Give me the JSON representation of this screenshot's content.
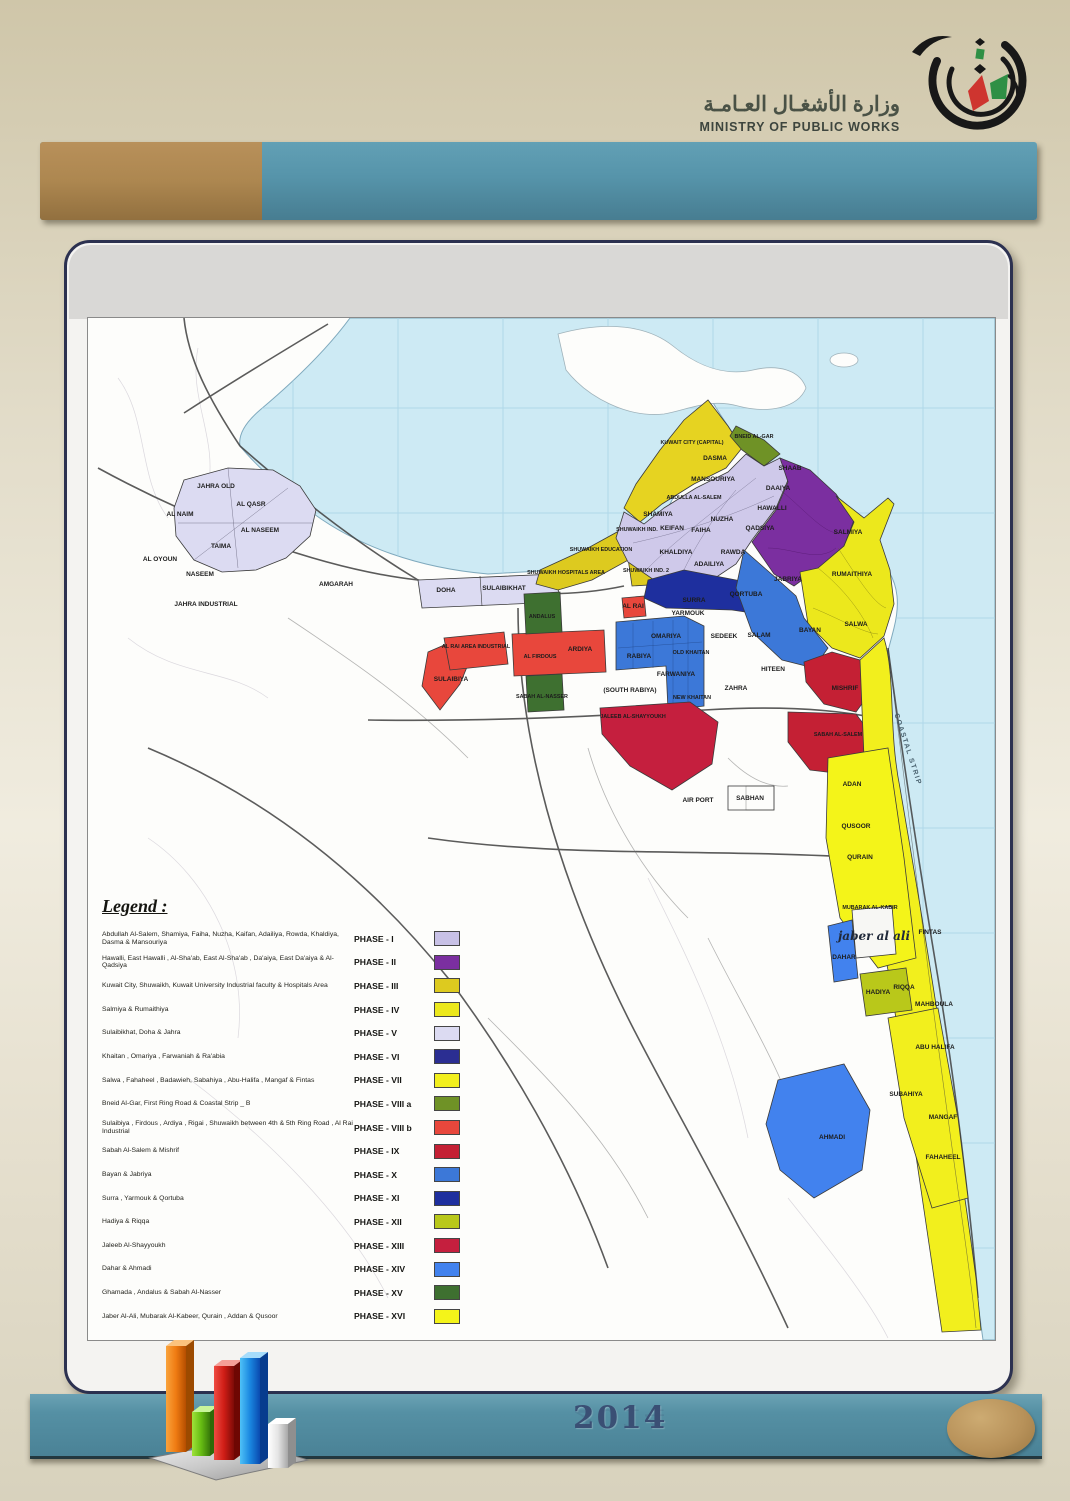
{
  "page": {
    "year": "2014"
  },
  "ministry": {
    "name_ar": "وزارة الأشغـال العـامـة",
    "name_en": "MINISTRY OF PUBLIC WORKS"
  },
  "theme": {
    "header_tan": "#ad8750",
    "header_teal": "#5694aa",
    "footer_teal": "#4f8ca0",
    "card_border": "#2c3150",
    "sea": "#cdeaf4",
    "year_color": "#3a4f74",
    "oval_tan": "#b8925a"
  },
  "legend": {
    "title": "Legend :",
    "entries": [
      {
        "areas": "Abdullah Al-Salem, Shamiya, Faiha, Nuzha, Kaifan, Adailiya, Rowda, Khaldiya, Dasma & Mansouriya",
        "phase": "PHASE - I",
        "color": "#c8c1e6"
      },
      {
        "areas": "Hawalli, East Hawalli , Al-Sha'ab, East Al-Sha'ab , Da'aiya, East Da'aiya & Al-Qadsiya",
        "phase": "PHASE - II",
        "color": "#7b2fa0"
      },
      {
        "areas": "Kuwait City, Shuwaikh, Kuwait University Industrial faculty & Hospitals Area",
        "phase": "PHASE - III",
        "color": "#ddca1f"
      },
      {
        "areas": "Salmiya & Rumaithiya",
        "phase": "PHASE - IV",
        "color": "#ece81c"
      },
      {
        "areas": "Sulaibikhat, Doha & Jahra",
        "phase": "PHASE - V",
        "color": "#dcdbf2"
      },
      {
        "areas": "Khaitan , Omariya , Farwaniah & Ra'abia",
        "phase": "PHASE - VI",
        "color": "#2b2e92"
      },
      {
        "areas": "Salwa , Fahaheel , Badawieh, Sabahiya , Abu-Halifa , Mangaf & Fintas",
        "phase": "PHASE - VII",
        "color": "#f2ef1d"
      },
      {
        "areas": "Bneid Al-Gar, First Ring Road & Coastal Strip _ B",
        "phase": "PHASE - VIII a",
        "color": "#6f9226"
      },
      {
        "areas": "Sulaibiya , Firdous , Ardiya , Rigai , Shuwaikh between 4th & 5th Ring Road , Al Rai Industrial",
        "phase": "PHASE - VIII b",
        "color": "#e8473c"
      },
      {
        "areas": "Sabah Al-Salem & Mishrif",
        "phase": "PHASE - IX",
        "color": "#c42034"
      },
      {
        "areas": "Bayan & Jabriya",
        "phase": "PHASE - X",
        "color": "#3c78d8"
      },
      {
        "areas": "Surra , Yarmouk & Qortuba",
        "phase": "PHASE - XI",
        "color": "#1e2f9e"
      },
      {
        "areas": "Hadiya & Riqqa",
        "phase": "PHASE - XII",
        "color": "#b9c81a"
      },
      {
        "areas": "Jaleeb Al-Shayyoukh",
        "phase": "PHASE - XIII",
        "color": "#c51f3e"
      },
      {
        "areas": "Dahar & Ahmadi",
        "phase": "PHASE - XIV",
        "color": "#4282ee"
      },
      {
        "areas": "Ghamada , Andalus & Sabah Al-Nasser",
        "phase": "PHASE - XV",
        "color": "#3e7030"
      },
      {
        "areas": "Jaber Al-Ali, Mubarak Al-Kabeer, Qurain , Addan & Qusoor",
        "phase": "PHASE - XVI",
        "color": "#f4f419"
      }
    ]
  },
  "map": {
    "labels": [
      {
        "t": "JAHRA OLD",
        "x": 128,
        "y": 170
      },
      {
        "t": "AL NAIM",
        "x": 92,
        "y": 198
      },
      {
        "t": "AL QASR",
        "x": 163,
        "y": 188
      },
      {
        "t": "AL NASEEM",
        "x": 172,
        "y": 214
      },
      {
        "t": "TAIMA",
        "x": 133,
        "y": 230
      },
      {
        "t": "AL OYOUN",
        "x": 72,
        "y": 243
      },
      {
        "t": "NASEEM",
        "x": 112,
        "y": 258
      },
      {
        "t": "JAHRA INDUSTRIAL",
        "x": 118,
        "y": 288
      },
      {
        "t": "AMGARAH",
        "x": 248,
        "y": 268
      },
      {
        "t": "DOHA",
        "x": 358,
        "y": 274
      },
      {
        "t": "SULAIBIKHAT",
        "x": 416,
        "y": 272
      },
      {
        "t": "KUWAIT CITY (CAPITAL)",
        "x": 604,
        "y": 126,
        "c": "small"
      },
      {
        "t": "BNEID AL-GAR",
        "x": 666,
        "y": 120,
        "c": "small"
      },
      {
        "t": "DASMA",
        "x": 627,
        "y": 142
      },
      {
        "t": "MANSOURIYA",
        "x": 625,
        "y": 163
      },
      {
        "t": "ABDULLA AL-SALEM",
        "x": 606,
        "y": 181,
        "c": "small"
      },
      {
        "t": "SHAMIYA",
        "x": 570,
        "y": 198
      },
      {
        "t": "KEIFAN",
        "x": 584,
        "y": 212
      },
      {
        "t": "FAIHA",
        "x": 613,
        "y": 214
      },
      {
        "t": "NUZHA",
        "x": 634,
        "y": 203
      },
      {
        "t": "RAWDA",
        "x": 645,
        "y": 236
      },
      {
        "t": "KHALDIYA",
        "x": 588,
        "y": 236
      },
      {
        "t": "ADAILIYA",
        "x": 621,
        "y": 248
      },
      {
        "t": "SHAAB",
        "x": 702,
        "y": 152
      },
      {
        "t": "DAAIYA",
        "x": 690,
        "y": 172
      },
      {
        "t": "HAWALLI",
        "x": 684,
        "y": 192
      },
      {
        "t": "QADSIYA",
        "x": 672,
        "y": 212
      },
      {
        "t": "SALMIYA",
        "x": 760,
        "y": 216
      },
      {
        "t": "RUMAITHIYA",
        "x": 764,
        "y": 258
      },
      {
        "t": "JABRIYA",
        "x": 700,
        "y": 263
      },
      {
        "t": "BAYAN",
        "x": 722,
        "y": 314
      },
      {
        "t": "SHUWAIKH IND.",
        "x": 549,
        "y": 213,
        "c": "small"
      },
      {
        "t": "SHUWAIKH EDUCATION",
        "x": 513,
        "y": 233,
        "c": "small"
      },
      {
        "t": "SHUWAIKH HOSPITALS AREA",
        "x": 478,
        "y": 256,
        "c": "small"
      },
      {
        "t": "SHUWAIKH IND. 2",
        "x": 558,
        "y": 254,
        "c": "small"
      },
      {
        "t": "AL RAI",
        "x": 545,
        "y": 290
      },
      {
        "t": "SURRA",
        "x": 606,
        "y": 284
      },
      {
        "t": "QORTUBA",
        "x": 658,
        "y": 278
      },
      {
        "t": "YARMOUK",
        "x": 600,
        "y": 297
      },
      {
        "t": "OMARIYA",
        "x": 578,
        "y": 320
      },
      {
        "t": "SEDEEK",
        "x": 636,
        "y": 320
      },
      {
        "t": "SALAM",
        "x": 671,
        "y": 319
      },
      {
        "t": "RABIYA",
        "x": 551,
        "y": 340
      },
      {
        "t": "OLD KHAITAN",
        "x": 603,
        "y": 336,
        "c": "small"
      },
      {
        "t": "FARWANIYA",
        "x": 588,
        "y": 358
      },
      {
        "t": "(SOUTH RABIYA)",
        "x": 542,
        "y": 374
      },
      {
        "t": "NEW KHAITAN",
        "x": 604,
        "y": 381,
        "c": "small"
      },
      {
        "t": "ZAHRA",
        "x": 648,
        "y": 372
      },
      {
        "t": "HITEEN",
        "x": 685,
        "y": 353
      },
      {
        "t": "AL RAI AREA INDUSTRIAL",
        "x": 388,
        "y": 330,
        "c": "small"
      },
      {
        "t": "SULAIBIYA",
        "x": 363,
        "y": 363
      },
      {
        "t": "AL FIRDOUS",
        "x": 452,
        "y": 340,
        "c": "small"
      },
      {
        "t": "ARDIYA",
        "x": 492,
        "y": 333
      },
      {
        "t": "ANDALUS",
        "x": 454,
        "y": 300,
        "c": "small"
      },
      {
        "t": "SABAH AL-NASSER",
        "x": 454,
        "y": 380,
        "c": "small"
      },
      {
        "t": "JALEEB AL-SHAYYOUKH",
        "x": 545,
        "y": 400,
        "c": "small"
      },
      {
        "t": "MISHRIF",
        "x": 757,
        "y": 372
      },
      {
        "t": "SABAH AL-SALEM",
        "x": 750,
        "y": 418,
        "c": "small"
      },
      {
        "t": "SALWA",
        "x": 768,
        "y": 308
      },
      {
        "t": "AIR PORT",
        "x": 610,
        "y": 484
      },
      {
        "t": "SABHAN",
        "x": 662,
        "y": 482
      },
      {
        "t": "ADAN",
        "x": 764,
        "y": 468
      },
      {
        "t": "QUSOOR",
        "x": 768,
        "y": 510
      },
      {
        "t": "QURAIN",
        "x": 772,
        "y": 541
      },
      {
        "t": "MUBARAK AL-KABIR",
        "x": 782,
        "y": 591,
        "c": "small"
      },
      {
        "t": "jaber al ali",
        "x": 786,
        "y": 622,
        "c": "annotation"
      },
      {
        "t": "FINTAS",
        "x": 842,
        "y": 616
      },
      {
        "t": "DAHAR",
        "x": 756,
        "y": 641
      },
      {
        "t": "HADIYA",
        "x": 790,
        "y": 676
      },
      {
        "t": "RIQQA",
        "x": 816,
        "y": 671
      },
      {
        "t": "MAHBOULA",
        "x": 846,
        "y": 688
      },
      {
        "t": "ABU HALIFA",
        "x": 847,
        "y": 731
      },
      {
        "t": "SUBAHIYA",
        "x": 818,
        "y": 778
      },
      {
        "t": "MANGAF",
        "x": 855,
        "y": 801
      },
      {
        "t": "FAHAHEEL",
        "x": 855,
        "y": 841
      },
      {
        "t": "AHMADI",
        "x": 744,
        "y": 821
      },
      {
        "t": "COASTAL STRIP",
        "x": 818,
        "y": 432,
        "c": "water",
        "r": 72
      }
    ]
  }
}
